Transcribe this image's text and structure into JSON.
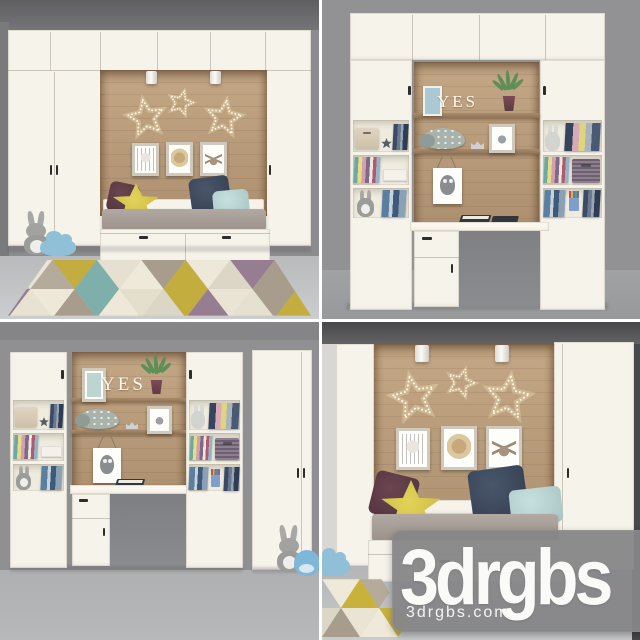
{
  "watermark": {
    "brand": "3drgbs",
    "website": "3drgbs.com"
  },
  "decor": {
    "shelf_letters": "YES"
  },
  "scenes": {
    "top_left": "kids bed nook with wardrobes, star lights and triangle rug",
    "top_right": "desk and shelving wall unit with YES letters",
    "bottom_left": "desk wall unit with wardrobe and plush toys",
    "bottom_right": "bed nook close-up with brand watermark"
  },
  "colors": {
    "gutter_white": "#ffffff",
    "furniture_white": "#f6f3eb",
    "wood_panel": "#b99c7c",
    "wall_gray": "#8e8e90",
    "ceiling_gray": "#6e6e70",
    "floor_gray": "#c4c6c7",
    "mattress_gray": "#a59c95",
    "pillow_plum": "#5b3b45",
    "pillow_yellow": "#d9c74d",
    "pillow_navy": "#3d4859",
    "pillow_mint": "#bad7d5",
    "rug_palette": [
      "#eee8d8",
      "#c3ad3e",
      "#7fafaa",
      "#a89d8c",
      "#977d92",
      "#dcd6c6"
    ],
    "watermark_plate": "#8a8a8b",
    "watermark_text": "#fafaf8"
  }
}
